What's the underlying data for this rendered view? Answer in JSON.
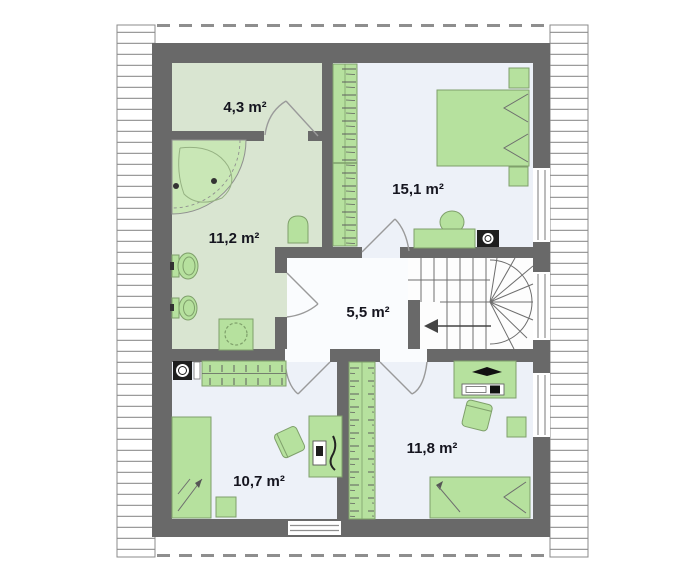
{
  "plan": {
    "title": "attic-floor-plan",
    "rooms": [
      {
        "name": "wardrobe-room",
        "area": "4,3 m²"
      },
      {
        "name": "bathroom",
        "area": "11,2 m²"
      },
      {
        "name": "bedroom-large",
        "area": "15,1 m²"
      },
      {
        "name": "hall",
        "area": "5,5 m²"
      },
      {
        "name": "bedroom-left",
        "area": "10,7 m²"
      },
      {
        "name": "bedroom-right",
        "area": "11,8 m²"
      }
    ]
  },
  "palette": {
    "wall": "#696969",
    "floorGreen": "#d9e5d1",
    "floorBlue": "#edf1f8",
    "floorHall": "#fafcfe",
    "furniture": "#b6e19e",
    "furnitureStroke": "#7fa06b",
    "tub": "#c9e7b6",
    "line": "#8f8f8f",
    "dash": "#8e8e8e",
    "text": "#15151f",
    "applianceDark": "#1e1e1e"
  }
}
